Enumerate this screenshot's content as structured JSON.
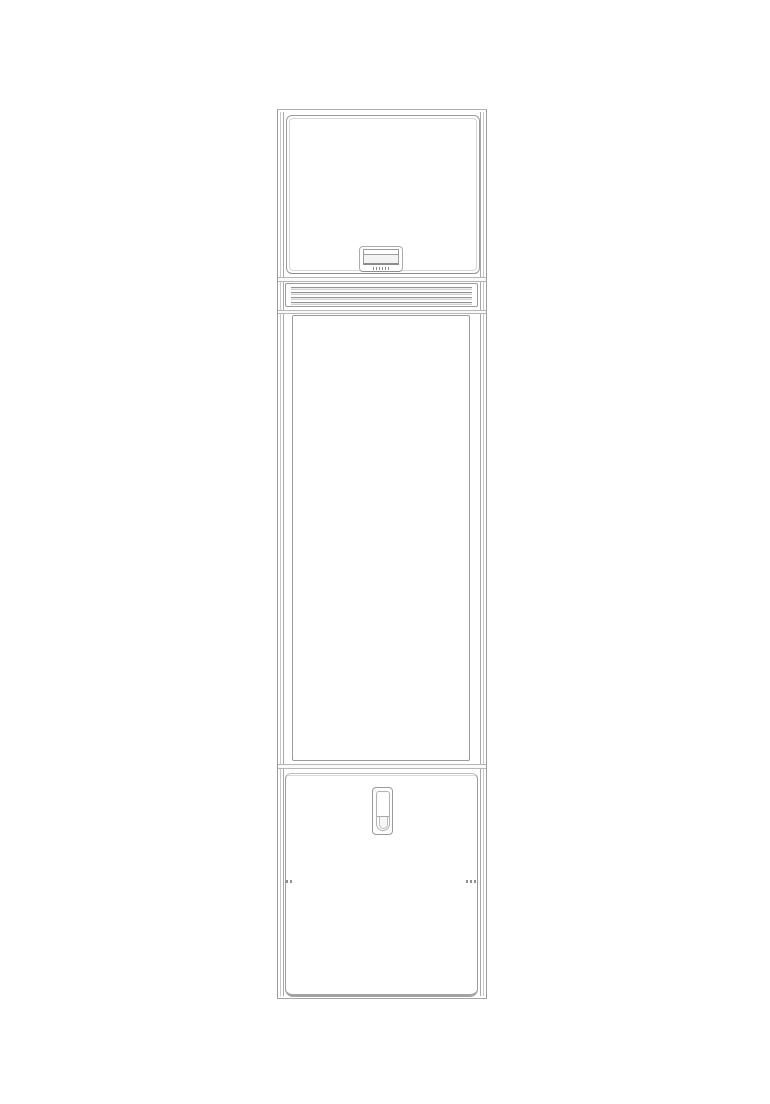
{
  "description": "Monochrome technical line drawing of a tall narrow cabinet unit (front elevation) centered on a white page",
  "palette": {
    "background": "#ffffff",
    "line_main": "#9b9b9b",
    "line_light": "#c9c9c9",
    "line_dark": "#8c8c8c"
  },
  "unit": {
    "sections": [
      {
        "label": "top access panel with small two-row nameplate and illegible micro-print"
      },
      {
        "label": "horizontal vent grille with 4 slats"
      },
      {
        "label": "large plain middle panel"
      },
      {
        "label": "bottom access door with recessed vertical pull handle and small edge latch marks"
      }
    ],
    "grille": {
      "slat_count": 4
    },
    "nameplate": {
      "rows": 2,
      "fine_print_legible": false
    },
    "visible_text": "none readable (only illegible micro-print under the nameplate window)"
  }
}
